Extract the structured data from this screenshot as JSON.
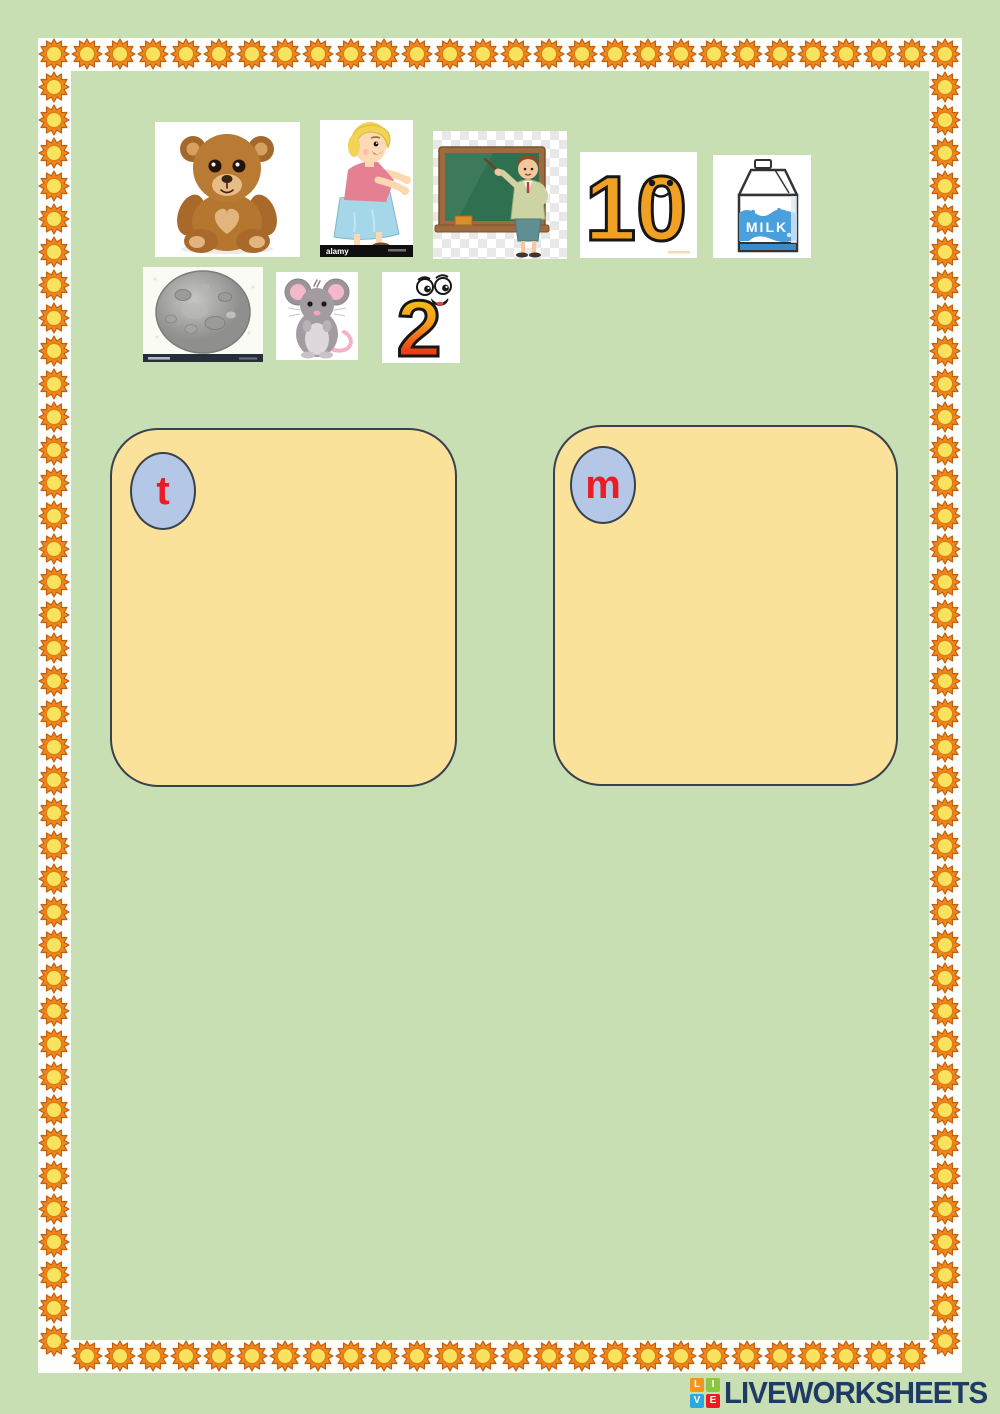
{
  "page": {
    "background_color": "#c8dfb4",
    "border": {
      "strip_color": "#fdfdfb",
      "sun_outer_color": "#f0861c",
      "sun_inner_color": "#f9e25e"
    }
  },
  "pictures": [
    {
      "name": "teddy-bear"
    },
    {
      "name": "mum",
      "watermark": "alamy"
    },
    {
      "name": "teacher"
    },
    {
      "name": "number-ten",
      "text": "10"
    },
    {
      "name": "milk",
      "text": "MILK"
    },
    {
      "name": "moon"
    },
    {
      "name": "mouse"
    },
    {
      "name": "number-two",
      "text": "2"
    }
  ],
  "sorting_boxes": [
    {
      "letter": "t",
      "fill": "#fbe29b",
      "circle_fill": "#b4c7e7",
      "letter_color": "#ea1c24"
    },
    {
      "letter": "m",
      "fill": "#fbe29b",
      "circle_fill": "#b4c7e7",
      "letter_color": "#ea1c24"
    }
  ],
  "footer": {
    "logo": {
      "squares": [
        {
          "letter": "L",
          "color": "#f7941e"
        },
        {
          "letter": "I",
          "color": "#8dc63f"
        },
        {
          "letter": "V",
          "color": "#29abe2"
        },
        {
          "letter": "E",
          "color": "#ed1c24"
        }
      ],
      "brand": "LIVEWORKSHEETS",
      "brand_color": "#1e3b66"
    }
  }
}
